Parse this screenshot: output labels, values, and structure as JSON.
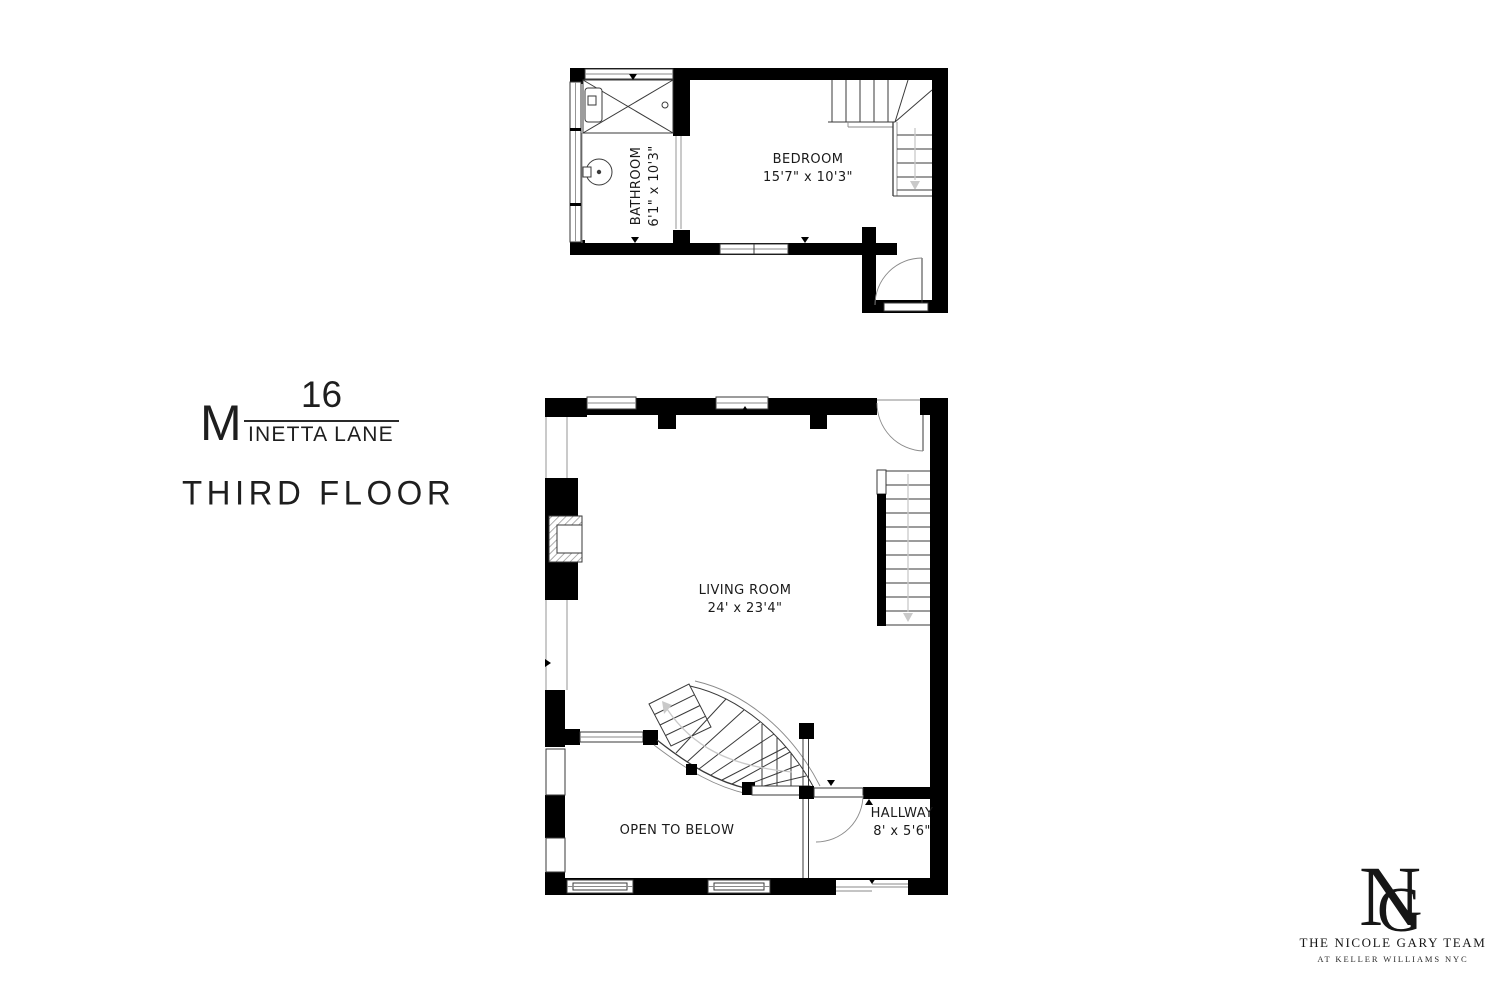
{
  "title_block": {
    "address_number": "16",
    "street_initial": "M",
    "street_rest": "INETTA LANE",
    "street_full": "MINETTA LANE",
    "floor_label": "THIRD FLOOR"
  },
  "upper_plan": {
    "bathroom": {
      "name": "BATHROOM",
      "dims": "6'1\" x 10'3\""
    },
    "bedroom": {
      "name": "BEDROOM",
      "dims": "15'7\" x 10'3\""
    }
  },
  "main_plan": {
    "living_room": {
      "name": "LIVING ROOM",
      "dims": "24' x 23'4\""
    },
    "open_to_below": {
      "name": "OPEN TO BELOW"
    },
    "hallway": {
      "name": "HALLWAY",
      "dims": "8' x 5'6\""
    }
  },
  "logo": {
    "monogram_n": "N",
    "monogram_g": "G",
    "team_name": "THE NICOLE GARY TEAM",
    "subtitle": "AT KELLER WILLIAMS NYC"
  },
  "colors": {
    "wall": "#000000",
    "line": "#3a3a3a",
    "text": "#1a1a1a",
    "walk_line": "#c9c9c9",
    "background": "#ffffff"
  }
}
